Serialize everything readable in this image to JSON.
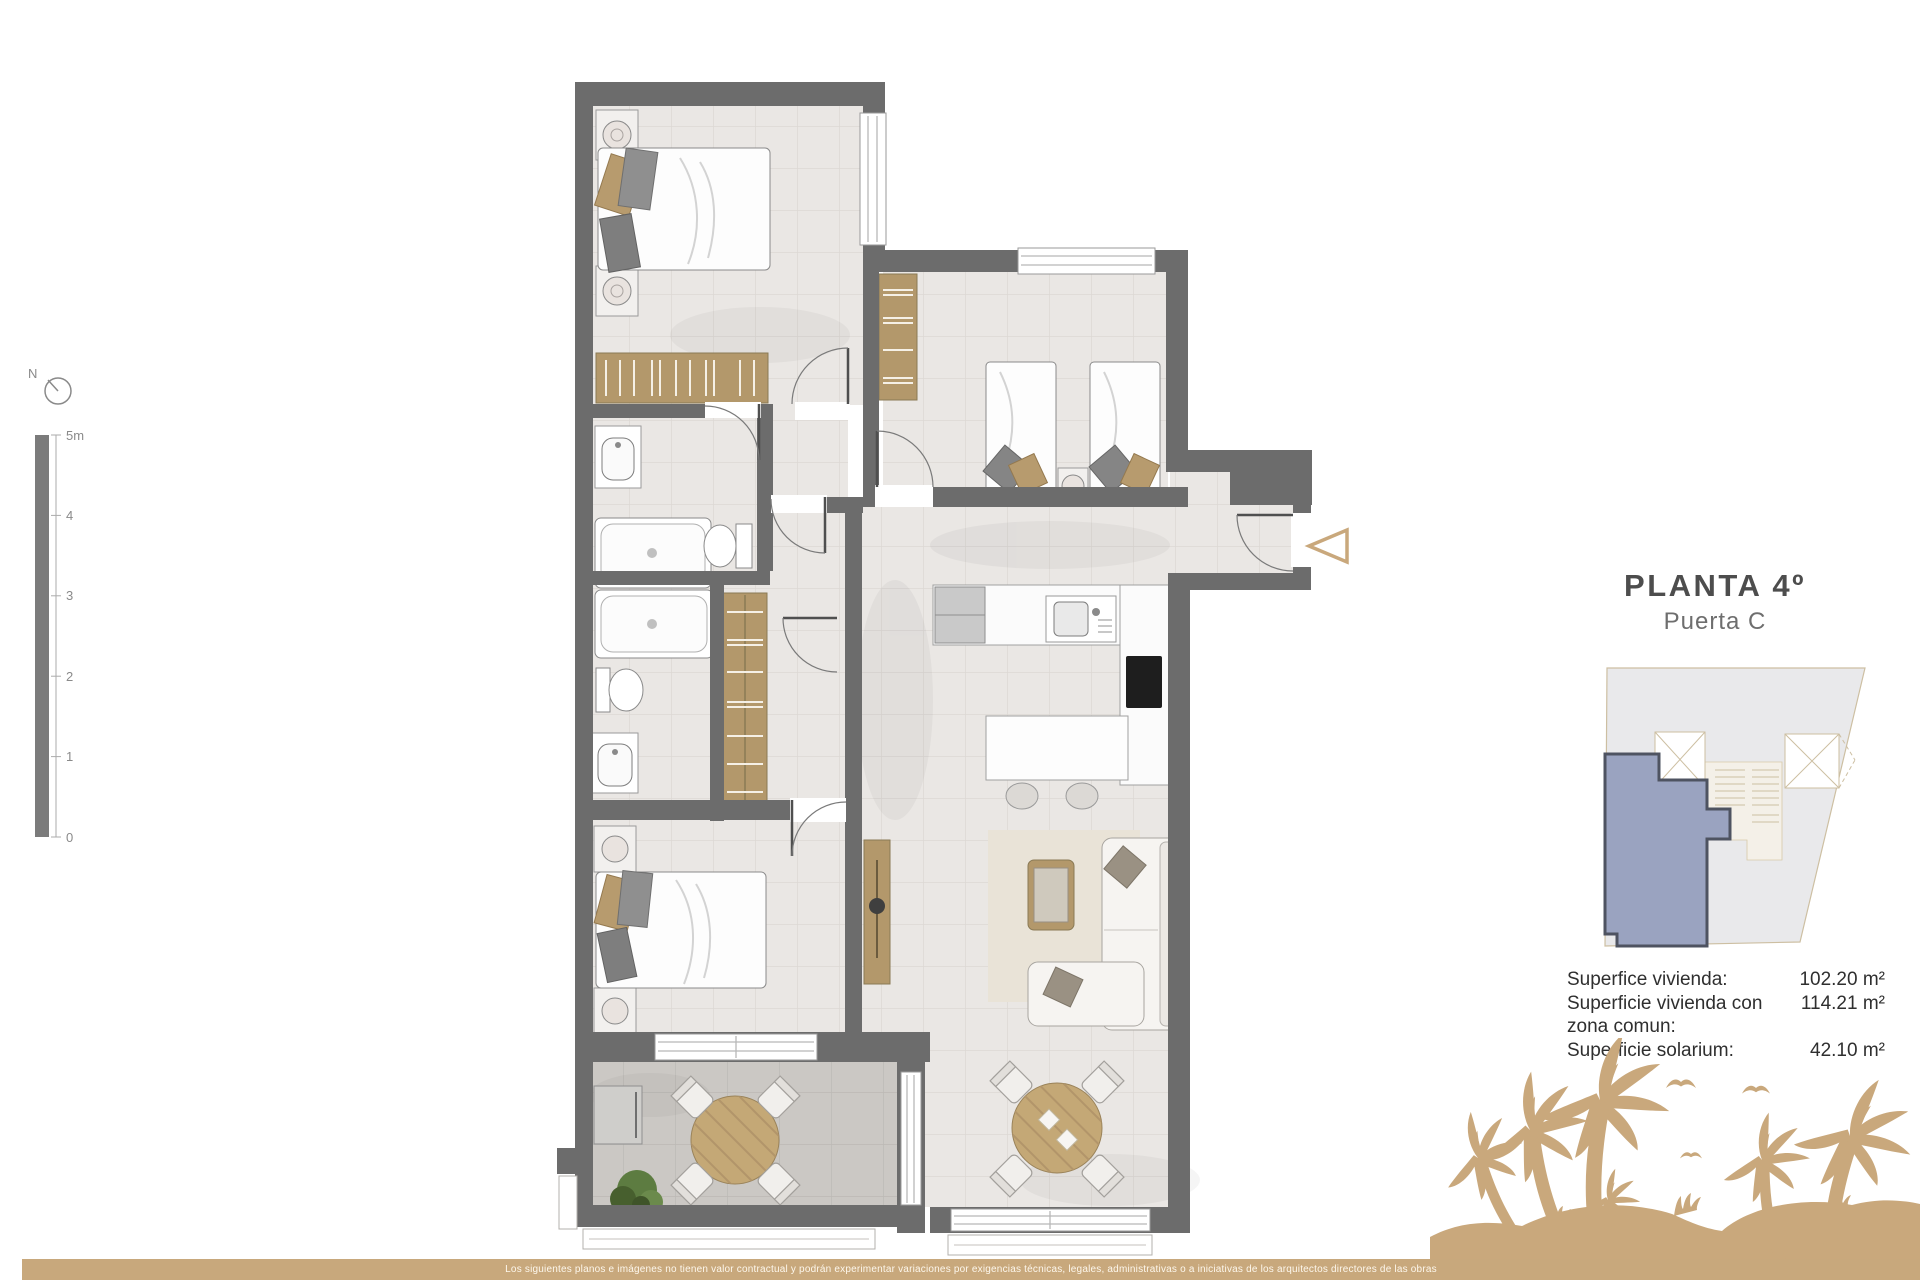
{
  "page": {
    "title": "PLANTA 4º",
    "subtitle": "Puerta C"
  },
  "surfaces": {
    "rows": [
      {
        "label": "Superfice vivienda:",
        "value": "102.20 m²"
      },
      {
        "label": "Superficie vivienda con zona comun:",
        "value": "114.21 m²"
      },
      {
        "label": "Superficie solarium:",
        "value": "42.10 m²"
      }
    ]
  },
  "scale": {
    "ticks": [
      "5m",
      "4",
      "3",
      "2",
      "1",
      "0"
    ]
  },
  "compass": {
    "label": "N"
  },
  "footer": {
    "disclaimer": "Los siguientes planos e imágenes no tienen valor contractual y podrán experimentar variaciones por exigencias técnicas, legales, administrativas o a iniciativas de los arquitectos directores de las obras"
  },
  "colors": {
    "accent_tan": "#c9a87c",
    "wall_gray": "#6c6c6c",
    "wood": "#b3986b",
    "unit_highlight": "#9aa3c0",
    "footer_bar": "#c8a87c"
  }
}
